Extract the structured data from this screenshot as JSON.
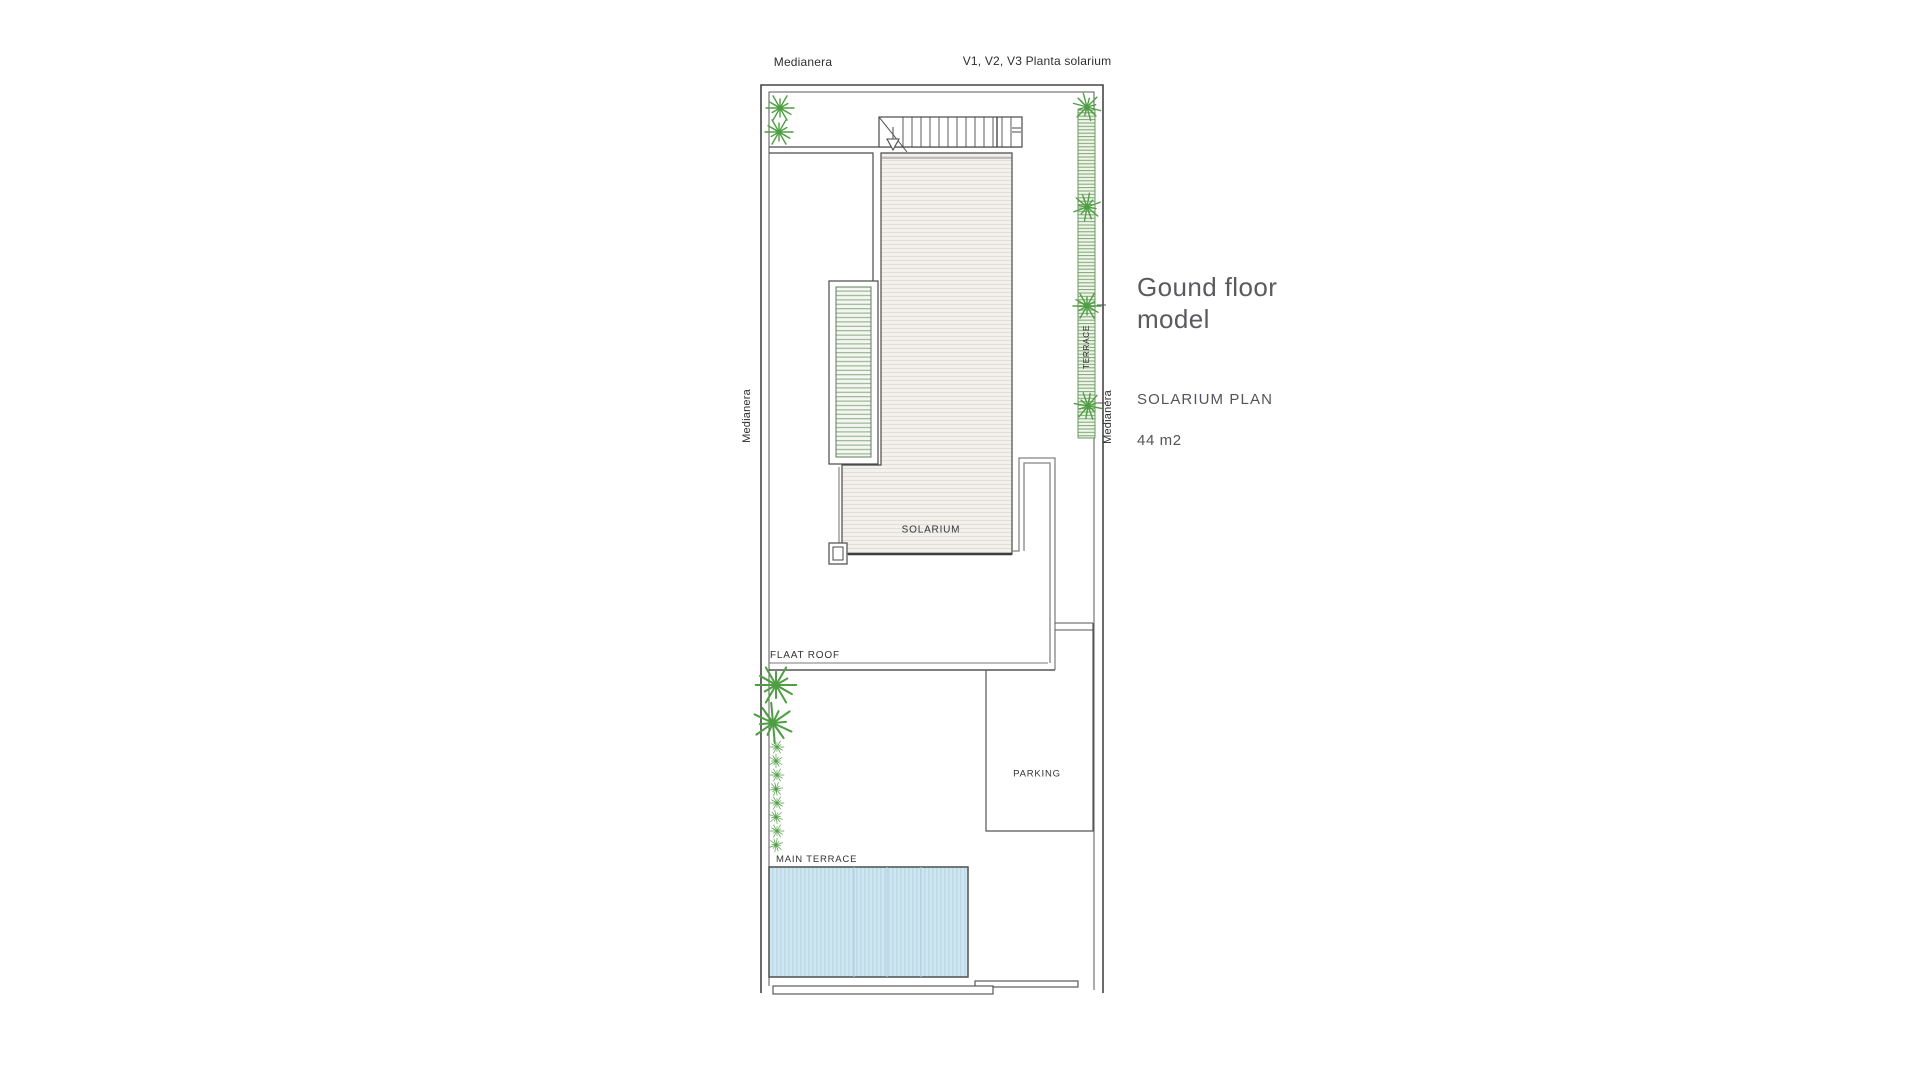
{
  "plan": {
    "labels": {
      "medianera_top": "Medianera",
      "views_note": "V1, V2, V3 Planta solarium",
      "medianera_left": "Medianera",
      "medianera_right": "Medianera",
      "terrace_side": "TERRACE",
      "solarium": "SOLARIUM",
      "flat_roof": "FLAAT ROOF",
      "parking": "PARKING",
      "main_terrace": "MAIN TERRACE"
    },
    "colors": {
      "wall_line": "#4a4a4a",
      "secondary_line": "#858585",
      "vegetation_green": "#4f9e44",
      "black_star": "#1f1f1f",
      "floor_fill": "#f2f1ee",
      "floor_hatch_line": "#dfdbd3",
      "planter_hatch_line": "#93ad8c",
      "terrace_strip_line": "#7aa56d",
      "pool_fill": "#cfe7f1",
      "pool_stripe": "#bcd9e6",
      "label_text": "#2e2e2e",
      "info_text": "#5b5b5f"
    }
  },
  "info_panel": {
    "title_line1": "Gound floor",
    "title_line2": "model",
    "subtitle": "SOLARIUM PLAN",
    "area": "44 m2"
  }
}
